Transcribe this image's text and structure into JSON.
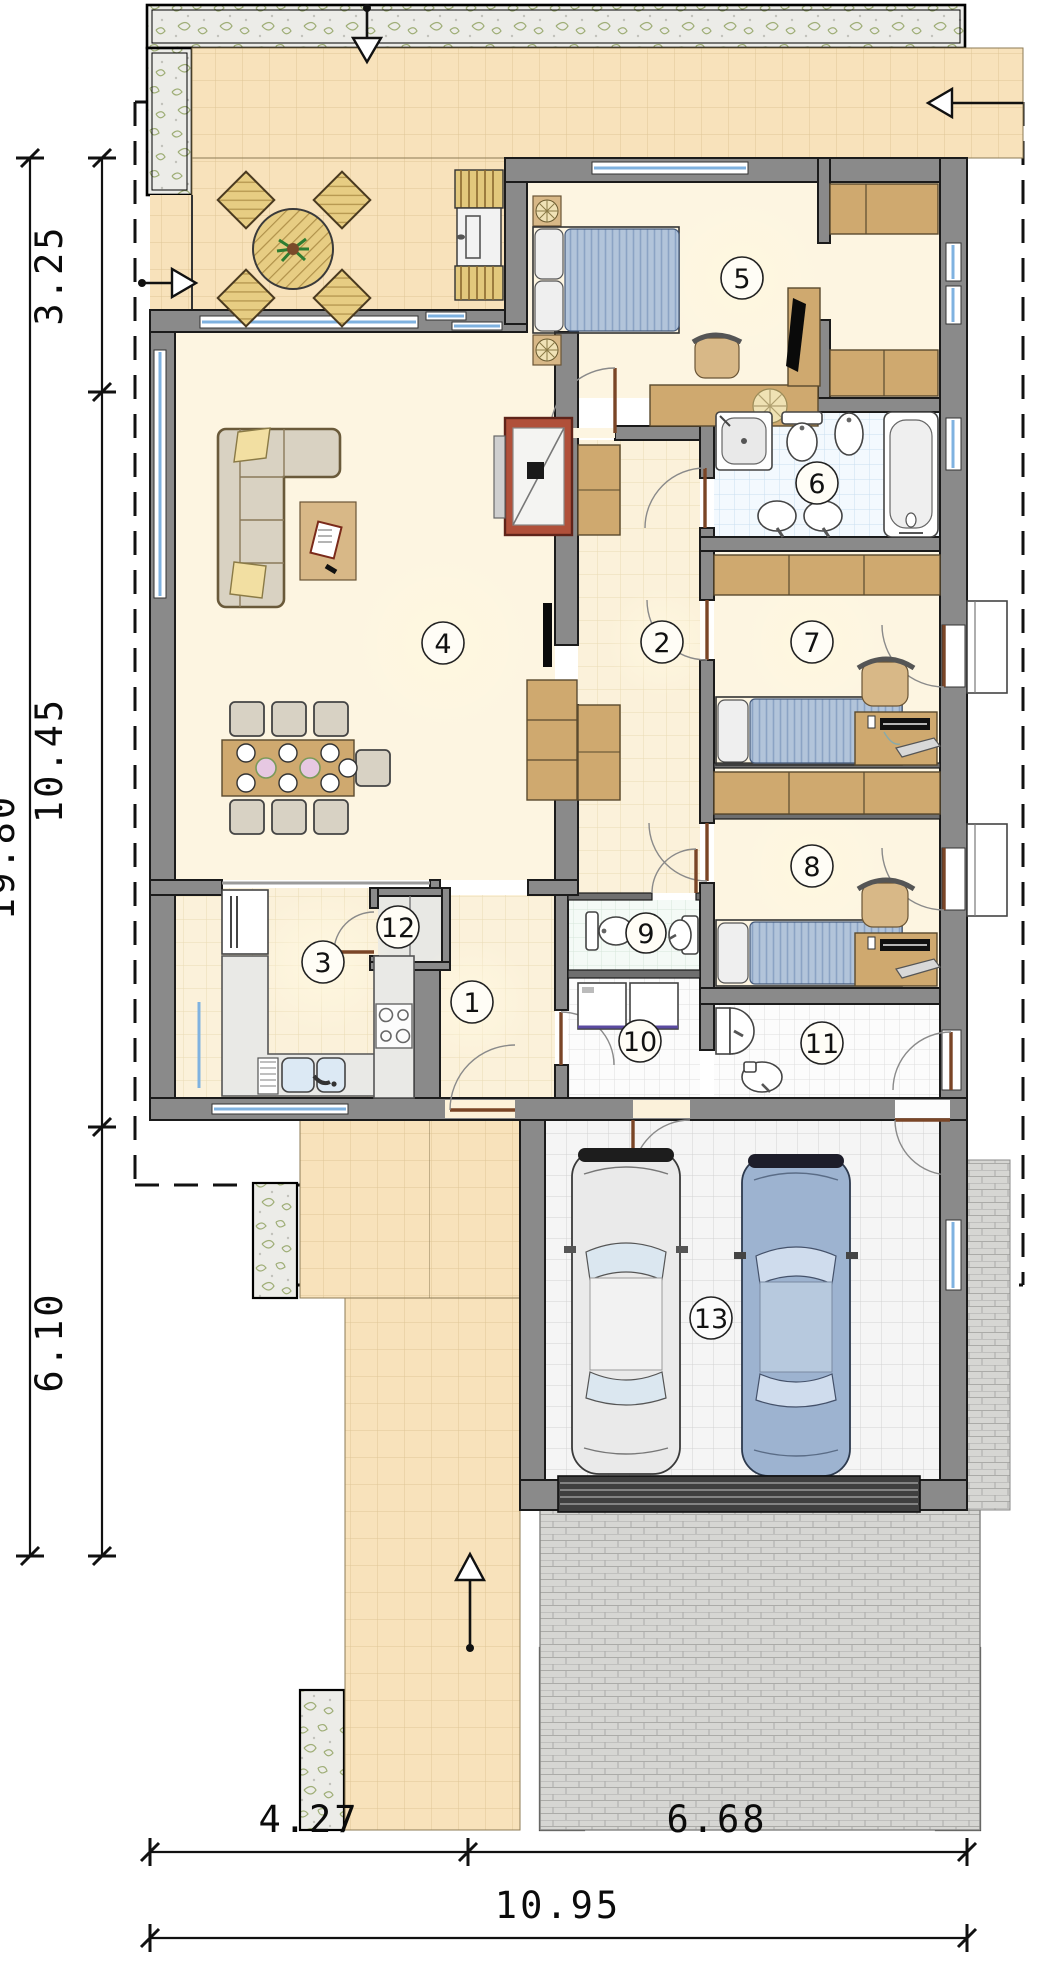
{
  "plan": {
    "meta": {
      "drawing_type": "house-floor-plan"
    },
    "rooms": [
      {
        "number": "1"
      },
      {
        "number": "2"
      },
      {
        "number": "3"
      },
      {
        "number": "4"
      },
      {
        "number": "5"
      },
      {
        "number": "6"
      },
      {
        "number": "7"
      },
      {
        "number": "8"
      },
      {
        "number": "9"
      },
      {
        "number": "10"
      },
      {
        "number": "11"
      },
      {
        "number": "12"
      },
      {
        "number": "13"
      }
    ],
    "dimensions": {
      "left": {
        "segments": [
          {
            "label": "3.25"
          },
          {
            "label": "10.45"
          },
          {
            "label": "6.10"
          }
        ],
        "total": {
          "label": "19.80"
        }
      },
      "bottom": {
        "segments": [
          {
            "label": "4.27"
          },
          {
            "label": "6.68"
          }
        ],
        "total": {
          "label": "10.95"
        }
      }
    },
    "colors": {
      "wall": "#8a8a8a",
      "terrace_tile": "#f8e2bb",
      "interior_floor": "#fdf5e1",
      "bath_tile": "#f3f9fe",
      "window_glass": "#7fb2e0",
      "furniture_wood": "#cfa96f",
      "bed_fabric": "#b2c4da",
      "fireplace": "#b0503a",
      "gravel": "#ecece8",
      "brick_paving": "#d6d6d3"
    }
  }
}
